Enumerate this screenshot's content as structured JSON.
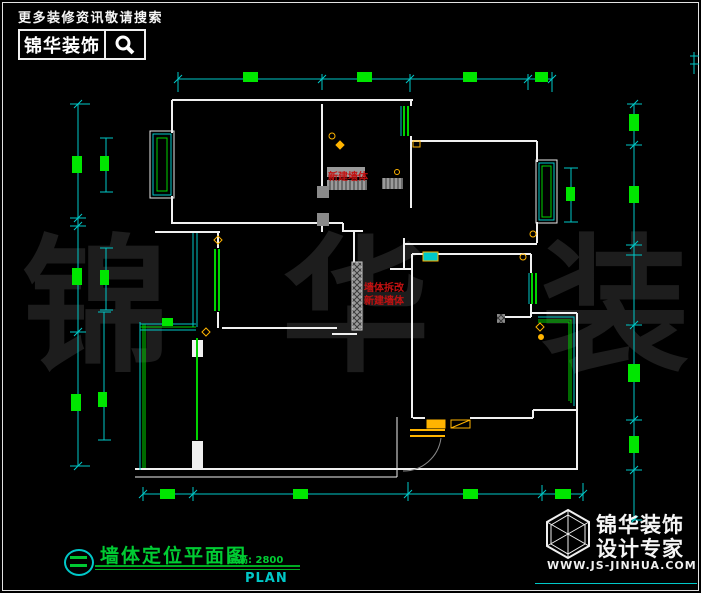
{
  "canvas": {
    "width": 701,
    "height": 593,
    "background": "#000000",
    "border_color": "#e2e2e2"
  },
  "colors": {
    "wall_white": "#f0f0f0",
    "dimension_cyan": "#00c8c8",
    "dim_label_green": "#00e600",
    "element_green": "#00d400",
    "annotation_red": "#c41111",
    "fixture_yellow": "#ffb400",
    "new_wall_gray": "#9a9a9a",
    "watermark_gray": "#1d1d1d",
    "title_green": "#00cc33"
  },
  "header": {
    "tagline": "更多装修资讯敬请搜索",
    "brand": "锦华装饰"
  },
  "watermark": {
    "text": "锦 华 装 饰"
  },
  "plan": {
    "annotations": {
      "new_wall_top": "新建墙体",
      "wall_change_line1": "墙体拆改",
      "wall_change_line2": "新建墙体"
    }
  },
  "title_block": {
    "title": "墙体定位平面图",
    "floor_height": "层高: 2800",
    "plan_label": "PLAN"
  },
  "footer_logo": {
    "brand_line1": "锦华装饰",
    "brand_line2": "设计专家",
    "website": "WWW.JS-JINHUA.COM"
  }
}
